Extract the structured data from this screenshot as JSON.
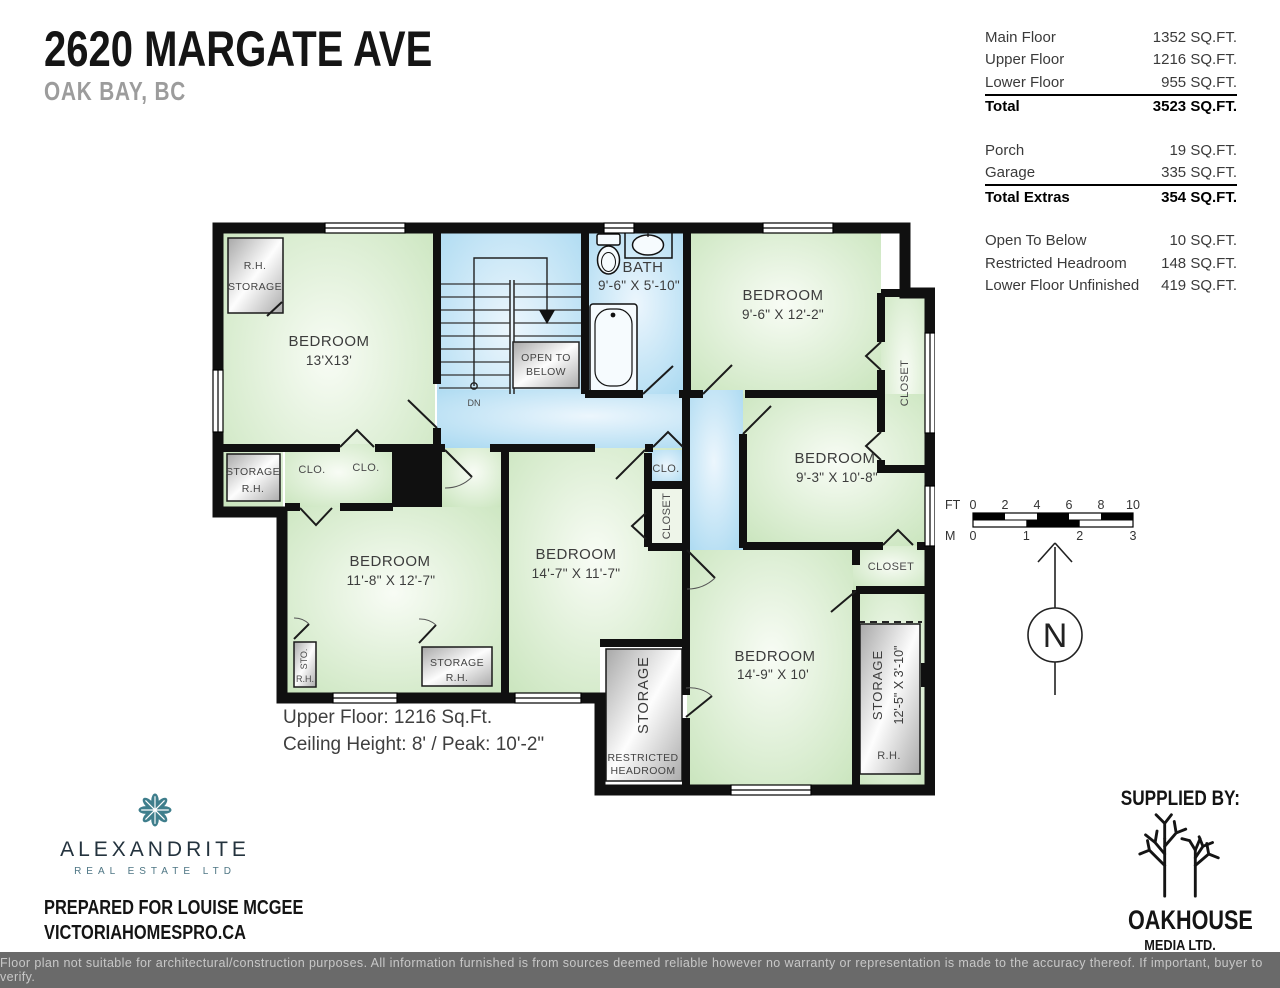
{
  "header": {
    "title": "2620 MARGATE AVE",
    "subtitle": "OAK BAY, BC"
  },
  "stats": {
    "rows": [
      {
        "label": "Main Floor",
        "value": "1352 SQ.FT."
      },
      {
        "label": "Upper Floor",
        "value": "1216 SQ.FT."
      },
      {
        "label": "Lower Floor",
        "value": "955 SQ.FT."
      },
      {
        "label": "Total",
        "value": "3523 SQ.FT."
      },
      {
        "label": "Porch",
        "value": "19 SQ.FT."
      },
      {
        "label": "Garage",
        "value": "335 SQ.FT."
      },
      {
        "label": "Total Extras",
        "value": "354 SQ.FT."
      },
      {
        "label": "Open To Below",
        "value": "10 SQ.FT."
      },
      {
        "label": "Restricted Headroom",
        "value": "148 SQ.FT."
      },
      {
        "label": "Lower Floor Unfinished",
        "value": "419 SQ.FT."
      }
    ]
  },
  "plan": {
    "rooms": {
      "bed13": {
        "name": "BEDROOM",
        "dims": "13'X13'"
      },
      "bed96": {
        "name": "BEDROOM",
        "dims": "9'-6\" X 12'-2\""
      },
      "bed93": {
        "name": "BEDROOM",
        "dims": "9'-3\" X 10'-8\""
      },
      "bed118": {
        "name": "BEDROOM",
        "dims": "11'-8\" X 12'-7\""
      },
      "bed147": {
        "name": "BEDROOM",
        "dims": "14'-7\" X 11'-7\""
      },
      "bed149": {
        "name": "BEDROOM",
        "dims": "14'-9\" X 10'"
      },
      "bath": {
        "name": "BATH",
        "dims": "9'-6\" X 5'-10\""
      }
    },
    "labels": {
      "rh": "R.H.",
      "storage": "STORAGE",
      "sto": "STO.",
      "clo": "CLO.",
      "closet": "CLOSET",
      "storage_dims": "12'-5\" X 3'-10\"",
      "restricted_1": "RESTRICTED",
      "restricted_2": "HEADROOM",
      "open_to_below_1": "OPEN TO",
      "open_to_below_2": "BELOW",
      "dn": "DN"
    },
    "notes": {
      "line1": "Upper Floor: 1216 Sq.Ft.",
      "line2": "Ceiling Height: 8' / Peak: 10'-2\""
    }
  },
  "scalebar": {
    "ft_label": "FT",
    "m_label": "M",
    "ft_ticks": [
      "0",
      "2",
      "4",
      "6",
      "8",
      "10"
    ],
    "m_ticks": [
      "0",
      "1",
      "2",
      "3"
    ],
    "north_letter": "N"
  },
  "branding": {
    "agency_name": "ALEXANDRITE",
    "agency_sub": "REAL ESTATE LTD",
    "prepared_for": "PREPARED FOR LOUISE MCGEE",
    "website": "VICTORIAHOMESPRO.CA",
    "supplied_by": "SUPPLIED BY:",
    "media_name": "OAKHOUSE",
    "media_sub": "MEDIA LTD.",
    "accent_teal": "#3F7E8C"
  },
  "footer": {
    "disclaimer": "Floor plan not suitable for architectural/construction purposes. All information furnished is from sources deemed reliable however no warranty or representation is made to the accuracy thereof. If important, buyer to verify."
  }
}
